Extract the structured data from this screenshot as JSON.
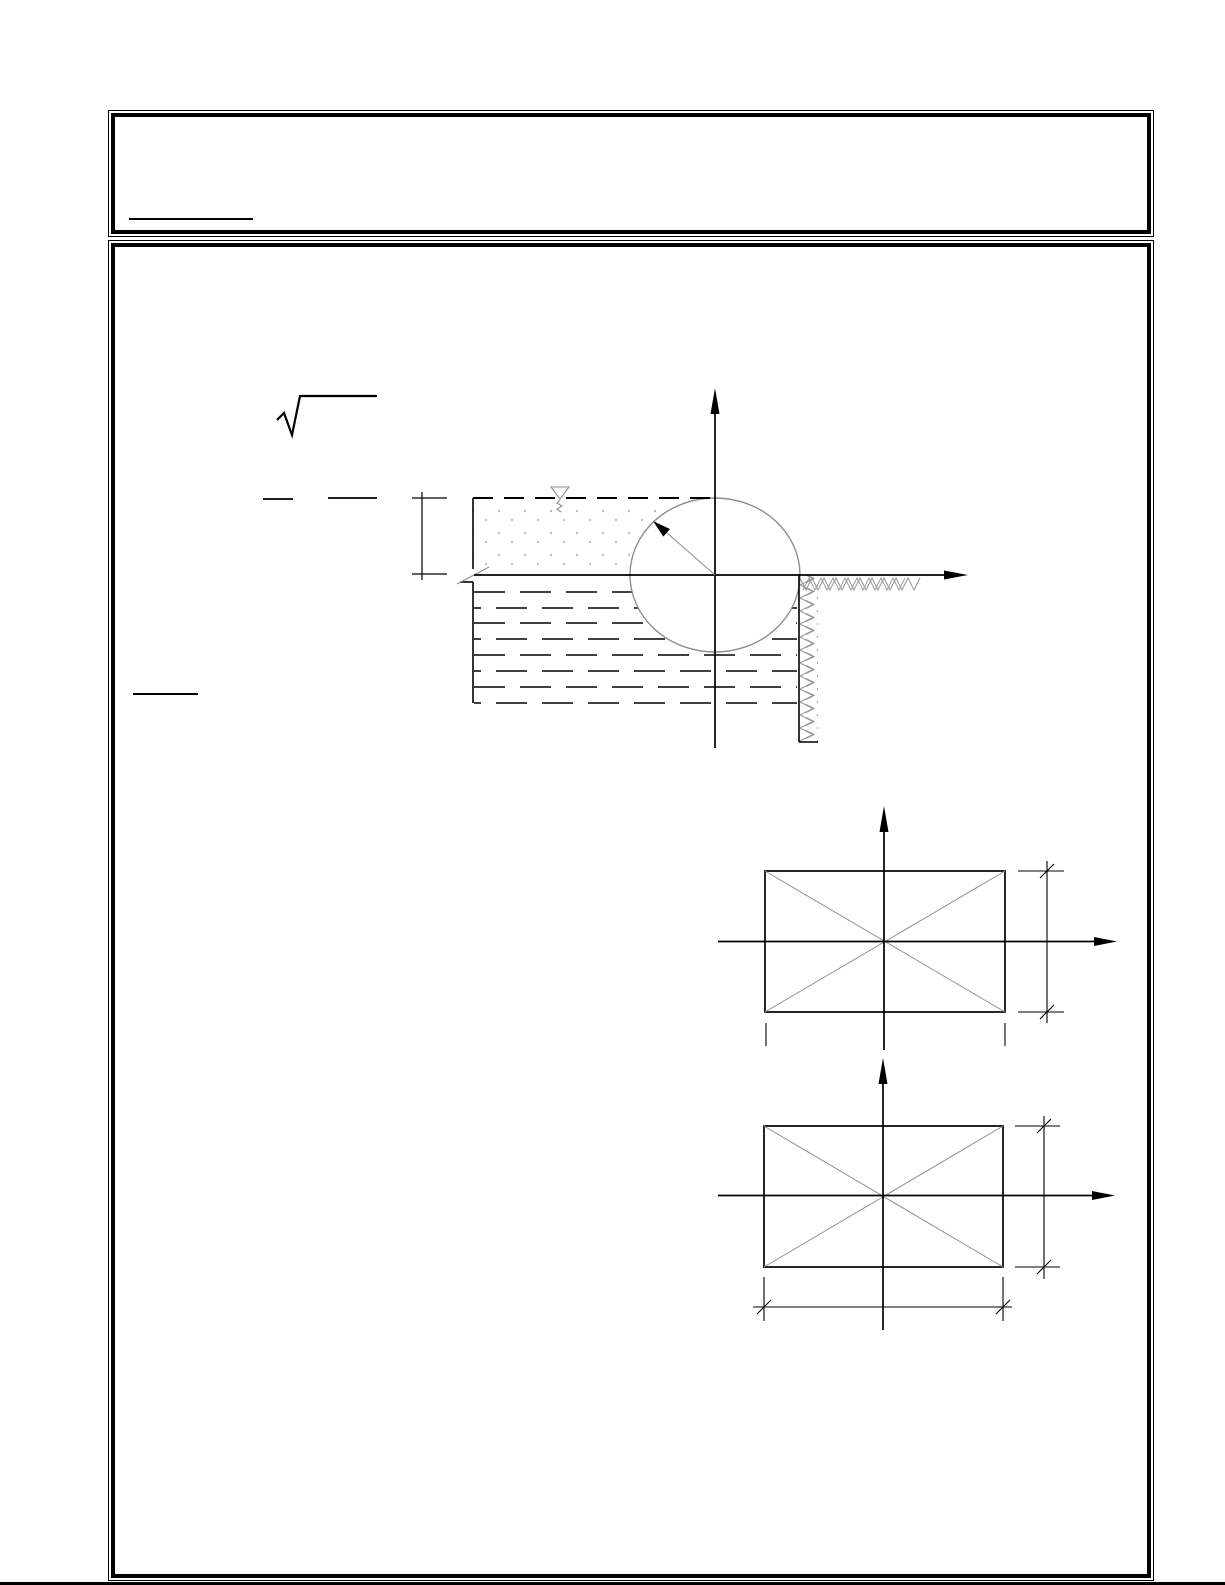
{
  "page": {
    "kind": "scanned-document-page",
    "width_px": 1225,
    "height_px": 1585,
    "visible_text": "",
    "note": "page contains only line drawings; all labels are blank in the pixels"
  },
  "theme": {
    "paper": "#ffffff",
    "ink": "#000000",
    "construction": "#8f8f8f",
    "hatch": "#9a9a9a",
    "stipple": "#bdbdbd"
  },
  "header_box": {
    "text": "",
    "underline_present": true
  },
  "main_box": {
    "sqrt_symbol_present": true,
    "underline_present": true
  },
  "figures": [
    {
      "id": "hydrostatic-circular-gate",
      "elements": [
        "water-level-icon",
        "dashed-free-surface-line",
        "depth-dimension-bracket",
        "stippled-soil-region",
        "liquid-dash-region",
        "circular-gate-outline",
        "radius-arrow",
        "vertical-axis-arrow",
        "horizontal-axis-arrow",
        "retaining-wall-hatch",
        "ground-surface-hatch",
        "line-break-symbol"
      ]
    },
    {
      "id": "rectangle-section-with-diagonals-1",
      "elements": [
        "rectangle-outline",
        "diagonal-cross-lines",
        "vertical-axis-arrow",
        "horizontal-axis-arrow",
        "height-dimension-line",
        "width-extension-ticks"
      ]
    },
    {
      "id": "rectangle-section-with-diagonals-2",
      "elements": [
        "rectangle-outline",
        "diagonal-cross-lines",
        "vertical-axis-arrow",
        "horizontal-axis-arrow",
        "height-dimension-line",
        "width-dimension-line"
      ]
    }
  ]
}
